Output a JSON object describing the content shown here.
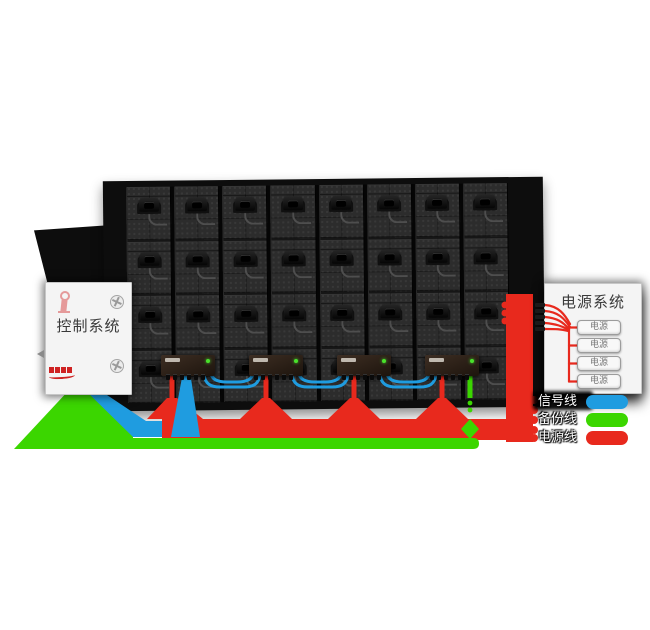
{
  "colors": {
    "signal_blue": "#1f9ce0",
    "backup_green": "#3bd600",
    "power_red": "#e8291d",
    "panel_black": "#0d0d0d",
    "module_gray": "#2c2c2c",
    "box_bg": "#f4f4f4"
  },
  "control_box": {
    "title": "控制系统"
  },
  "power_box": {
    "title": "电源系统",
    "unit_label": "电源",
    "unit_count": 4
  },
  "led_panel": {
    "columns": 8,
    "module_rows": 4,
    "receiver_cards": 4
  },
  "legend": {
    "items": [
      {
        "label": "信号线",
        "color": "#1f9ce0"
      },
      {
        "label": "备份线",
        "color": "#3bd600"
      },
      {
        "label": "电源线",
        "color": "#e8291d"
      }
    ]
  }
}
